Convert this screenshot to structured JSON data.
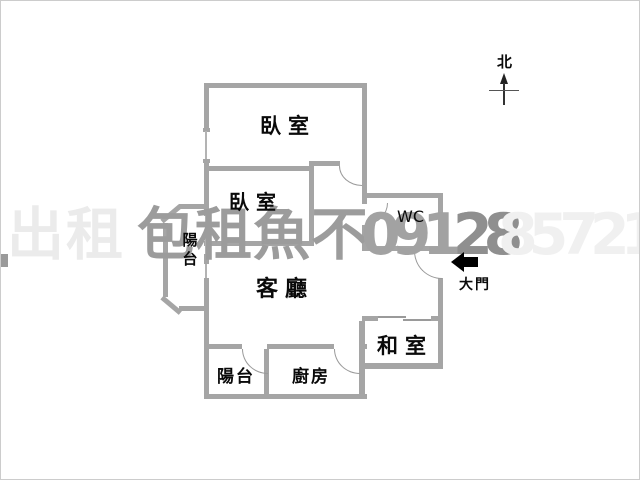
{
  "compass": {
    "north_label": "北"
  },
  "rooms": {
    "bedroom_top": "臥室",
    "bedroom_mid": "臥室",
    "wc": "WC",
    "living_room": "客廳",
    "balcony_left": "陽台",
    "tatami_room": "和室",
    "balcony_bottom": "陽台",
    "kitchen": "廚房"
  },
  "entrance": {
    "label": "大門"
  },
  "watermark": {
    "segments": [
      {
        "text": "出租",
        "x": 6,
        "y": 206,
        "color": "#ebebeb",
        "spacing": 2
      },
      {
        "text": "包租魚不",
        "x": 136,
        "y": 206,
        "color": "#9c9c9c",
        "spacing": 1
      },
      {
        "text": "0912",
        "x": 360,
        "y": 206,
        "color": "#a2a2a2",
        "spacing": -9
      },
      {
        "text": "28",
        "x": 452,
        "y": 206,
        "color": "#8f8f8f",
        "spacing": -9
      },
      {
        "text": "85721",
        "x": 497,
        "y": 206,
        "color": "#f0f0f0",
        "spacing": -9
      }
    ]
  },
  "colors": {
    "wall": "#a5a5a5",
    "window": "#b3b3b3",
    "door_arc": "#9a9a9a",
    "text": "#0a0a0a",
    "entrance_arrow": "#000000",
    "frame_border": "#cccccc"
  }
}
